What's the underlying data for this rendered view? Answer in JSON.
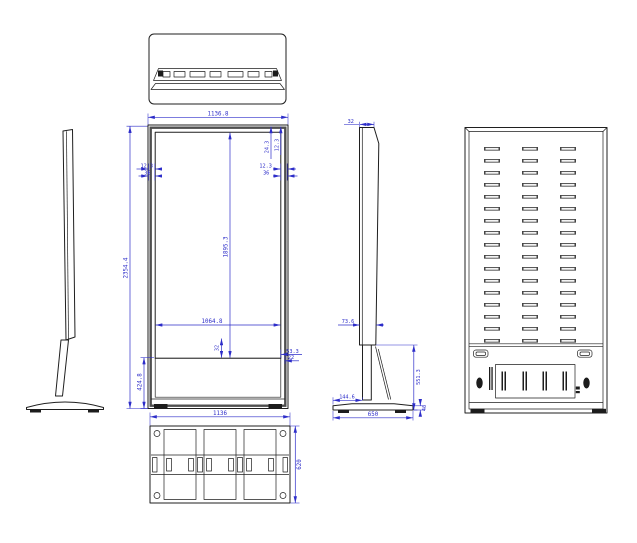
{
  "colors": {
    "geometry_line": "#1f1f1f",
    "dimension_line": "#2d2dc9",
    "background": "#ffffff"
  },
  "views": {
    "front": {
      "dims": {
        "width_top": "1136.8",
        "height_overall": "2354.4",
        "screen_height": "1895.3",
        "screen_width": "1064.8",
        "top_offset_a": "24.3",
        "top_offset_b": "12.3",
        "bezel_a": "12.3",
        "bezel_b": "36",
        "bottom_gap": "32",
        "corner_a": "53.3",
        "corner_b": "22",
        "base_height": "424.8"
      }
    },
    "side": {
      "dims": {
        "depth_top": "32",
        "depth_body": "73.6",
        "stand_height": "551.3",
        "foot_offset": "144.6",
        "base_depth": "650",
        "base_thickness": "46"
      }
    },
    "bottom": {
      "dims": {
        "width": "1136",
        "depth": "620"
      }
    }
  }
}
